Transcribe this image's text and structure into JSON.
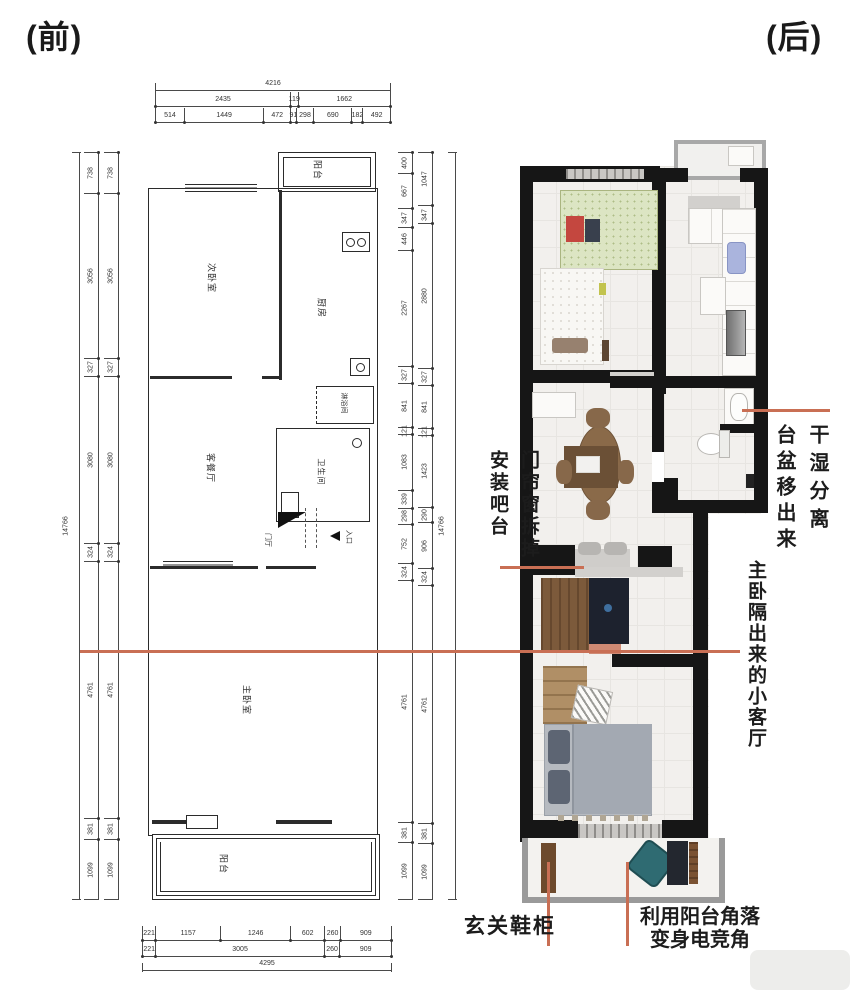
{
  "page": {
    "label_before": "(前)",
    "label_after": "(后)"
  },
  "colors": {
    "annotation_line": "#c96f54",
    "wall": "#161616",
    "cad_line": "#2b2b2b",
    "floor": "#f2f0ed",
    "balcony_frame": "#9a9a9a",
    "gaming_chair_teal": "#2f6b72",
    "watermark": "#ededeb"
  },
  "cad": {
    "rooms": {
      "balcony_top": "阳台",
      "bedroom2": "次卧室",
      "kitchen": "厨房",
      "shower": "淋浴间",
      "living": "客餐厅",
      "bathroom": "卫生间",
      "hall": "门厅",
      "entrance": "入口",
      "master": "主卧室",
      "balcony_bottom": "阳台"
    },
    "dims": {
      "top_total": "4216",
      "top_mid": [
        "2435",
        "119",
        "1662"
      ],
      "top_detail": [
        "514",
        "1449",
        "472",
        "91",
        "298",
        "690",
        "182",
        "492"
      ],
      "left_total": "14766",
      "left_segs": [
        "738",
        "3056",
        "327",
        "3080",
        "324",
        "4761",
        "381",
        "1099"
      ],
      "right_total": "14766",
      "right_inner": [
        "400",
        "667",
        "347",
        "446",
        "2267",
        "327",
        "841",
        "121",
        "1083",
        "339",
        "298",
        "752",
        "324",
        "4761",
        "381",
        "1099"
      ],
      "right_outer": [
        "1047",
        "347",
        "2880",
        "327",
        "841",
        "121",
        "1423",
        "290",
        "906",
        "324",
        "4761",
        "381",
        "1099"
      ],
      "bottom_detail": [
        "221",
        "1157",
        "1246",
        "602",
        "260",
        "909"
      ],
      "bottom_mid": [
        "221",
        "3005",
        "260",
        "909"
      ],
      "bottom_total": "4295"
    }
  },
  "annotations": {
    "basin": {
      "col_right": "干湿分离",
      "col_left": "台盆移出来"
    },
    "bar": {
      "col_right": "门帘窗拆掉",
      "col_left": "安装吧台"
    },
    "living": {
      "text": "主卧隔出来的小客厅"
    },
    "shoe": {
      "text": "玄关鞋柜"
    },
    "gaming": {
      "line1": "利用阳台角落",
      "line2": "变身电竞角"
    }
  }
}
